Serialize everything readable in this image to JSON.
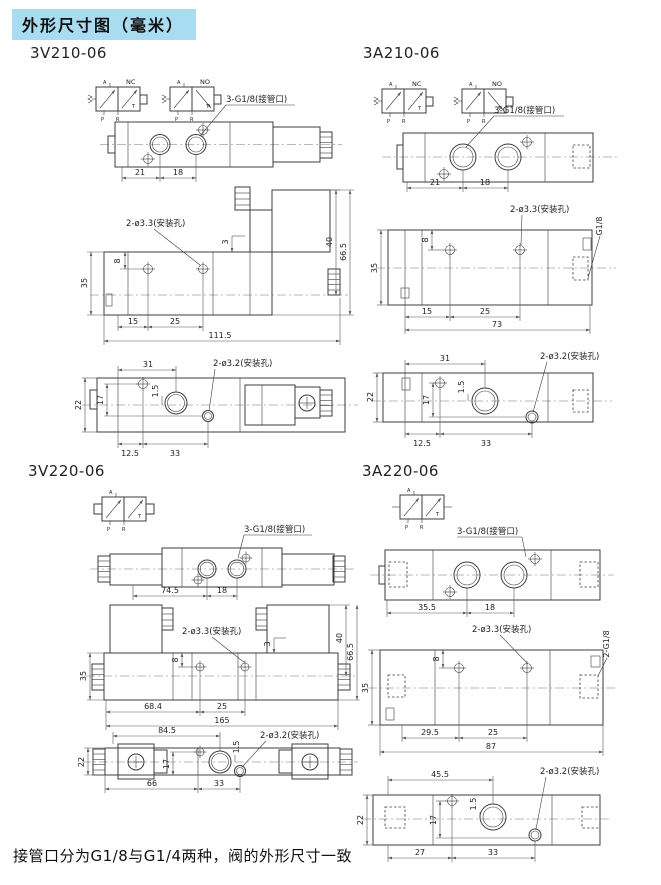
{
  "header": {
    "title": "外形尺寸图（毫米）"
  },
  "footer": {
    "note": "接管口分为G1/8与G1/4两种，阀的外形尺寸一致"
  },
  "symbol_labels": {
    "nc": "NC",
    "no": "NO",
    "a": "A",
    "p": "P",
    "r": "R",
    "t": "T"
  },
  "annotations": {
    "ports_g18": "3-G1/8(接管口)",
    "holes_33": "2-ø3.3(安装孔)",
    "holes_32": "2-ø3.2(安装孔)",
    "g18": "G1/8",
    "g18_2": "2-G1/8"
  },
  "sections": {
    "v210": {
      "model": "3V210-06",
      "top": {
        "w1": "21",
        "w2": "18"
      },
      "side": {
        "h_hole": "8",
        "h_body": "35",
        "step": "3",
        "l1": "15",
        "l2": "25",
        "total": "111.5",
        "h_coil": "40",
        "h_total": "66.5"
      },
      "bottom": {
        "w_port": "31",
        "offset": "1.5",
        "h_body": "22",
        "h_holes": "17",
        "l1": "12.5",
        "l2": "33"
      }
    },
    "a210": {
      "model": "3A210-06",
      "top": {
        "w1": "21",
        "w2": "18"
      },
      "side": {
        "h_hole": "8",
        "h_body": "35",
        "l1": "15",
        "l2": "25",
        "total": "73"
      },
      "bottom": {
        "w_port": "31",
        "offset": "1.5",
        "h_body": "22",
        "h_holes": "17",
        "l1": "12.5",
        "l2": "33"
      }
    },
    "v220": {
      "model": "3V220-06",
      "top": {
        "w1": "74.5",
        "w2": "18"
      },
      "side": {
        "h_hole": "8",
        "h_body": "35",
        "step": "3",
        "l1": "68.4",
        "l2": "25",
        "total": "165",
        "h_coil": "40",
        "h_total": "66.5"
      },
      "bottom": {
        "w_port": "84.5",
        "offset": "1.5",
        "h_body": "22",
        "h_holes": "17",
        "l1": "66",
        "l2": "33"
      }
    },
    "a220": {
      "model": "3A220-06",
      "top": {
        "w1": "35.5",
        "w2": "18"
      },
      "side": {
        "h_hole": "8",
        "h_body": "35",
        "l1": "29.5",
        "l2": "25",
        "total": "87"
      },
      "bottom": {
        "w_port": "45.5",
        "offset": "1.5",
        "h_body": "22",
        "h_holes": "17",
        "l1": "27",
        "l2": "33"
      }
    }
  }
}
